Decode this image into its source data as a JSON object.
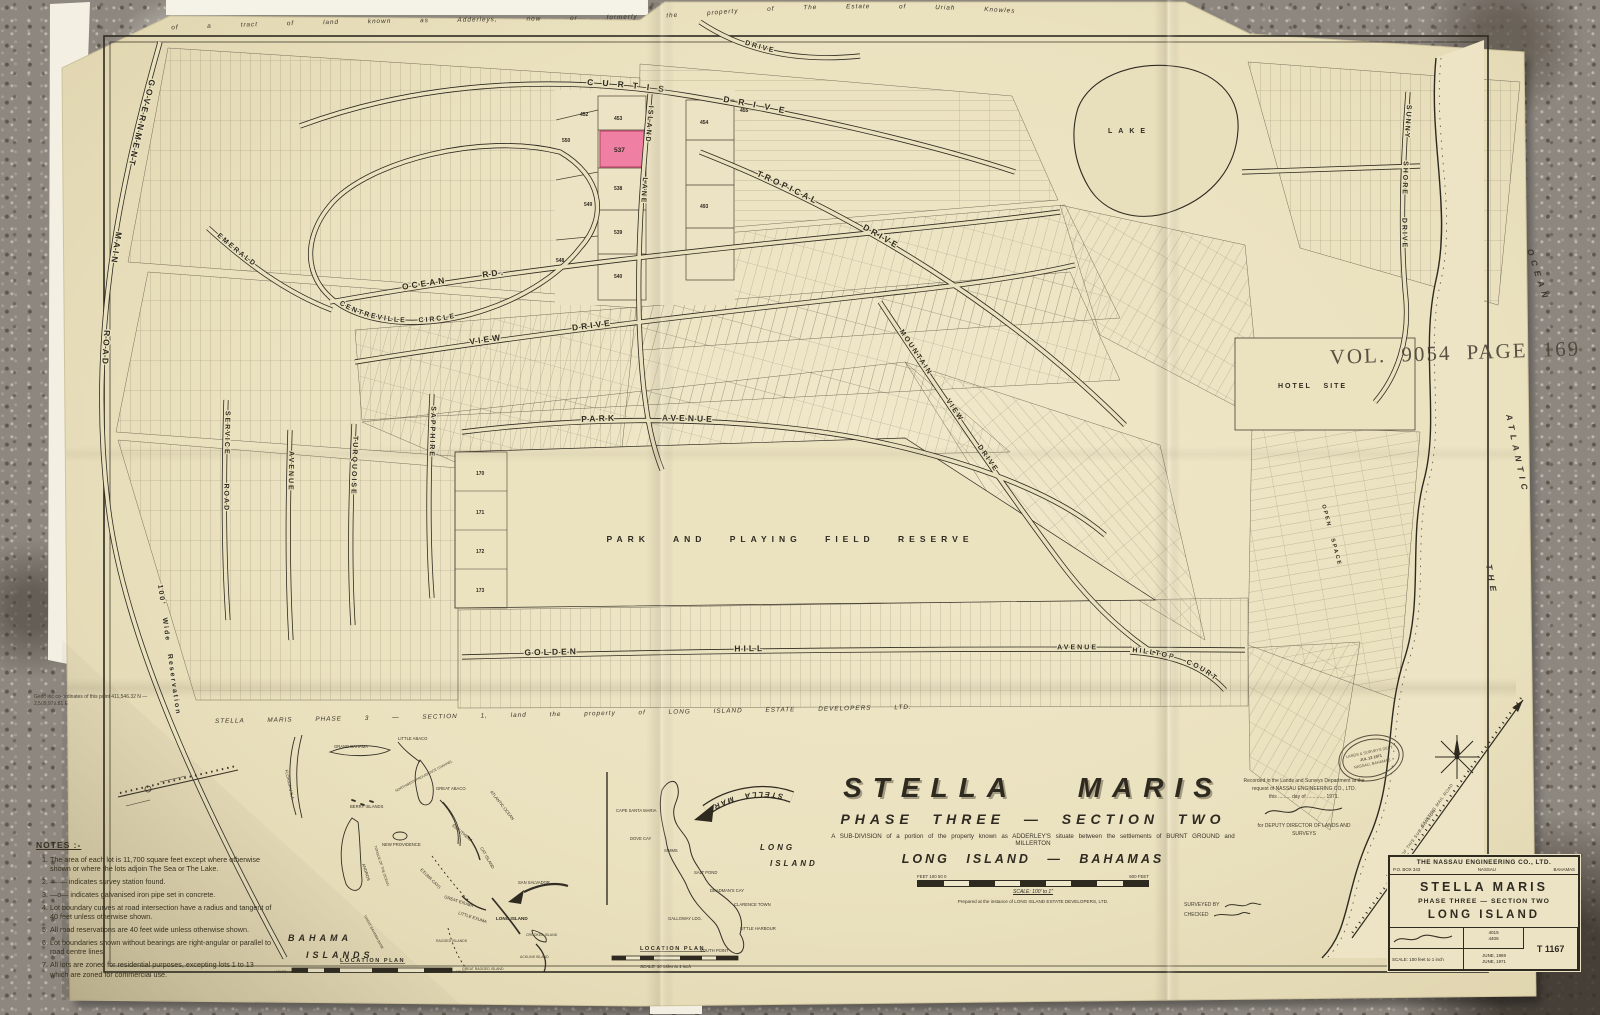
{
  "boundary": {
    "top": "of a tract of land known as Adderleys, now or formerly the property of The Estate of Uriah Knowles",
    "bottom": "STELLA MARIS PHASE 3 — SECTION 1, land the property of LONG ISLAND ESTATE DEVELOPERS LTD."
  },
  "stamps": {
    "vol_page": "VOL. 9054 PAGE 169",
    "oval_line1": "LANDS & SURVEYS DEPT.",
    "oval_line2": "JUL 13 1971",
    "oval_line3": "NASSAU, BAHAMAS"
  },
  "map": {
    "streets": {
      "government_main_road": "GOVERNMENT MAIN ROAD",
      "reservation": "100' Wide Reservation",
      "curtis_drive": "CURTIS DRIVE",
      "centreville_circle": "CENTREVILLE CIRCLE",
      "island_lane": "ISLAND LANE",
      "tropical_drive": "TROPICAL DRIVE",
      "drive_ne": "DRIVE",
      "ocean_rd": "OCEAN RD.",
      "view_drive": "VIEW DRIVE",
      "park_avenue": "PARK AVENUE",
      "golden_hill": "GOLDEN HILL",
      "avenue_east": "AVENUE",
      "hilltop_court": "HILLTOP COURT",
      "mountain_view_drive": "MOUNTAIN VIEW DRIVE",
      "sunny_shore_drive": "SUNNY SHORE DRIVE",
      "emerald": "EMERALD",
      "sapphire": "SAPPHIRE",
      "turquoise": "TURQUOISE",
      "avenue_west": "AVENUE",
      "service_road": "SERVICE ROAD"
    },
    "labels": {
      "park_reserve": "PARK AND PLAYING FIELD RESERVE",
      "hotel_site": "HOTEL SITE",
      "lake": "LAKE",
      "open_space": "OPEN SPACE",
      "sea_the": "THE",
      "sea_atlantic": "ATLANTIC",
      "sea_ocean": "OCEAN"
    },
    "highlight_lot": {
      "number": "537"
    },
    "lots_nearby": {
      "top_left": "452",
      "above": "453",
      "top_right": "455",
      "left_top": "550",
      "left_mid": "549",
      "left_low": "548",
      "below_1": "538",
      "below_2": "539",
      "below_3": "540",
      "right_top": "454",
      "right_mid": "493",
      "right_low": "536"
    },
    "park_col": [
      "170",
      "171",
      "172",
      "173"
    ],
    "coords_note": "Geodetic co-ordinates of this point 411,546.32 N — 2,509,979.81 E"
  },
  "notes": {
    "heading": "NOTES :-",
    "items": [
      "The area of each lot is 11,700 square feet except where otherwise shown or where the lots adjoin The Sea or The Lake.",
      "—·— indicates survey station found.",
      "—o— indicates galvanised iron pipe set in concrete.",
      "Lot boundary curves at road intersection have a radius and tangent of 40 feet unless otherwise shown.",
      "All road reservations are 40 feet wide unless otherwise shown.",
      "Lot boundaries shown without bearings are right-angular or parallel to road centre lines.",
      "All lots are zoned for residential purposes, excepting lots 1 to 13 which are zoned for commercial use."
    ]
  },
  "title_area": {
    "title": "STELLA MARIS",
    "phase": "PHASE THREE — SECTION TWO",
    "subdivision": "A SUB-DIVISION of a portion of the property known as ADDERLEY'S situate between the settlements of BURNT GROUND and MILLERTON",
    "location": "LONG ISLAND — BAHAMAS",
    "scale_units_left": "FEET 100  50  0",
    "scale_units_right": "600 FEET",
    "scale_note": "SCALE: 100' to 1\"",
    "prepared": "Prepared at the instance of LONG ISLAND ESTATE DEVELOPERS, LTD."
  },
  "certification": {
    "line1": "Recorded in the Lands and Surveys Department at the",
    "line2": "request of NASSAU ENGINEERING CO., LTD.",
    "line3": "this ......... day of ............. 1971.",
    "sig_title1": "for DEPUTY DIRECTOR OF LANDS AND",
    "sig_title2": "SURVEYS"
  },
  "credits": {
    "surveyed": "SURVEYED BY",
    "checked": "CHECKED"
  },
  "title_block": {
    "company": "THE NASSAU ENGINEERING CO., LTD.",
    "po_box": "P.O. BOX 343",
    "city": "NASSAU",
    "country": "BAHAMAS",
    "project": "STELLA MARIS",
    "phase": "PHASE THREE — SECTION TWO",
    "island": "LONG ISLAND",
    "job_no_1": "4015",
    "job_no_2": "4406",
    "date_1": "JUNE, 1969",
    "date_2": "JUNE, 1971",
    "sheet_no": "T 1167",
    "scale": "SCALE: 100 feet to 1 inch"
  },
  "meridian": {
    "label_1": "EXISTING MAIL ROAD",
    "label_2": "NOT PART OF THIS SUB-DIVISION"
  },
  "insets": {
    "bahamas": {
      "labels": [
        "FLORIDA U.S.A.",
        "GRAND BAHAMA",
        "LITTLE ABACO",
        "GREAT ABACO",
        "BERRY ISLANDS",
        "NEW PROVIDENCE",
        "ANDROS",
        "ELEUTHERA",
        "CAT ISLAND",
        "SAN SALVADOR",
        "EXUMA CAYS",
        "GREAT EXUMA",
        "LITTLE EXUMA",
        "LONG ISLAND",
        "RAGGED ISLANDS",
        "GREAT RAGGED ISLAND",
        "CROOKED ISLAND",
        "ACKLINS ISLAND",
        "ATLANTIC OCEAN",
        "NORTHWEST PROVIDENCE CHANNEL",
        "TONGUE OF THE OCEAN",
        "GREAT BAHAMA BANK"
      ],
      "caption_1": "BAHAMA",
      "caption_2": "ISLANDS",
      "plan_label": "LOCATION PLAN",
      "miles_left": "MILES",
      "miles_right": "MILES"
    },
    "long_island": {
      "banner": "STELLA MARIS",
      "name_1": "LONG",
      "name_2": "ISLAND",
      "places": [
        "CAPE SANTA MARIA",
        "DOVE CAY",
        "SIMMS",
        "SALT POND",
        "GALLOWAY LDG.",
        "DEADMAN'S CAY",
        "CLARENCE TOWN",
        "LITTLE HARBOUR",
        "SOUTH POINT"
      ],
      "plan_label": "LOCATION PLAN",
      "scale_note": "SCALE: 10 Miles to 1 inch"
    }
  },
  "colors": {
    "paper": "#eae1bf",
    "ink": "#2e2a20",
    "highlight_pink": "#ef7fa3"
  }
}
